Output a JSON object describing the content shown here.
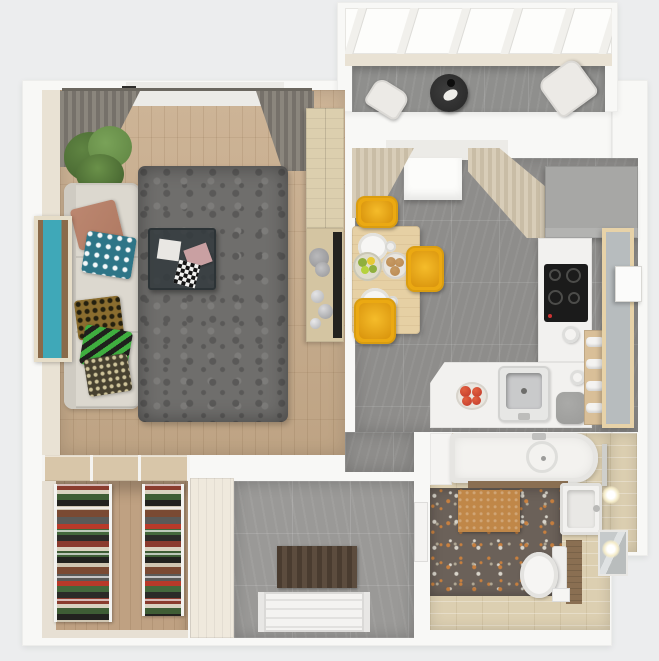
{
  "scene": {
    "type": "3d-floor-plan-render",
    "view": "top-down",
    "description": "Photorealistic top-down 3D render of a one-bedroom apartment: living room with L-sofa and shag rug, kitchen with yellow dining chairs, glazed balcony with lounge chairs, entry hall with doormat and front door, walk-in closet with clothes racks, and bathroom with tub, toilet and vanity."
  },
  "palette": {
    "background": "#ecedee",
    "wall": "#f8f8f6",
    "inner_wall_cream": "#e9e2d4",
    "wood_floor": "#c8ac8b",
    "window_white": "#fcfcfa",
    "curtain_gray": "#8b867d",
    "curtain_cream": "#d8cdb8",
    "plant_green": "#5f8442",
    "plant_dark": "#3f5c2b",
    "sofa_cream": "#dcd8cf",
    "cushion_brown": "#b07a63",
    "cushion_teal": "#2e7587",
    "cushion_gold": "#8a6d2f",
    "cushion_green": "#3fae3f",
    "cushion_dark": "#474130",
    "frame_cream": "#e6ddc8",
    "painting_teal": "#3fa8b8",
    "painting_brown": "#8a6a4a",
    "rug_gray": "#6f6e6c",
    "rug_dark": "#5a5958",
    "magazine_pink": "#c9a0a2",
    "wood_cabinet": "#dccfae",
    "wood_shelf": "#d4c5a2",
    "tv_dark": "#23221f",
    "decor_silver": "#b0b1b3",
    "glass_roof": "#fdfdfb",
    "mullion": "#f1f0ec",
    "balcony_tile": "#8f8f8d",
    "chair_white": "#eceae6",
    "side_table_black": "#262626",
    "kitchen_tile": "#8e8d8b",
    "cabinet_gray": "#a7a7a5",
    "counter_white": "#f2f1ef",
    "cooktop_black": "#1b1b1b",
    "sink_steel": "#c9cacb",
    "tomato_red": "#c0392b",
    "bin_gray": "#9b9b99",
    "ladder_wood": "#d9bf98",
    "pantry_wood": "#e7d2a8",
    "pantry_glass": "#b7bcbe",
    "boiler_white": "#fbfbfa",
    "dining_wood": "#e6d0a4",
    "chair_yellow": "#eba912",
    "fruit_green": "#8faf3e",
    "muffin_brown": "#b98952",
    "closet_door_wood": "#d8c6a9",
    "closet_floor": "#bfa182",
    "closet_wall": "#e7e0d4",
    "rack_white": "#f4f4f2",
    "wardrobe_cream": "#efe9dd",
    "marble_tile": "#9a9997",
    "mat_brown": "#4a3c30",
    "door_white": "#f4f3f1",
    "beige_tile": "#dccfb1",
    "terrazzo": "#6b6159",
    "terrazzo_speck_orange": "#c8803f",
    "terrazzo_speck_light": "#d8d4ca",
    "bath_mat": "#c08748",
    "tub_white": "#f3f2ef",
    "wood_trim": "#8a6f52",
    "toilet_white": "#f6f5f3",
    "mirror_gray": "#b9bdbd",
    "sconce_glow": "#f5ecc9"
  },
  "rooms": [
    {
      "id": "living-room",
      "floor": "light oak parquet",
      "items": [
        "L-shaped cream sofa with patterned pillows",
        "gray shag rug",
        "dark glass coffee table",
        "teal wall art",
        "potted plant",
        "window with gray curtains",
        "tall wood cabinet",
        "TV panel with decor shelf"
      ]
    },
    {
      "id": "balcony",
      "floor": "gray tile",
      "items": [
        "glazed roof",
        "two white lounge chairs",
        "round black side table"
      ]
    },
    {
      "id": "kitchen",
      "floor": "gray stone tile",
      "items": [
        "wood dining table",
        "three yellow chairs",
        "two place settings",
        "fruit bowl",
        "muffin plate",
        "window with cream curtains and roman shade",
        "gray corner cabinets",
        "induction cooktop",
        "stainless sink counter",
        "tomato bowl",
        "trash bin",
        "towel ladder",
        "pantry cabinet with frosted door",
        "wall boiler"
      ]
    },
    {
      "id": "entry-hall",
      "floor": "gray marble tile",
      "items": [
        "cream wardrobe",
        "brown striped doormat",
        "white front door"
      ]
    },
    {
      "id": "walk-in-closet",
      "floor": "wood",
      "items": [
        "sliding door track",
        "two clothes racks with folded garments"
      ]
    },
    {
      "id": "bathroom",
      "floor": "terrazzo with beige tile border",
      "items": [
        "bathtub with round drain",
        "tan bath mat",
        "toilet with wood panel",
        "vanity basin",
        "wall mirror",
        "two glowing sconces",
        "towel bar"
      ]
    }
  ]
}
